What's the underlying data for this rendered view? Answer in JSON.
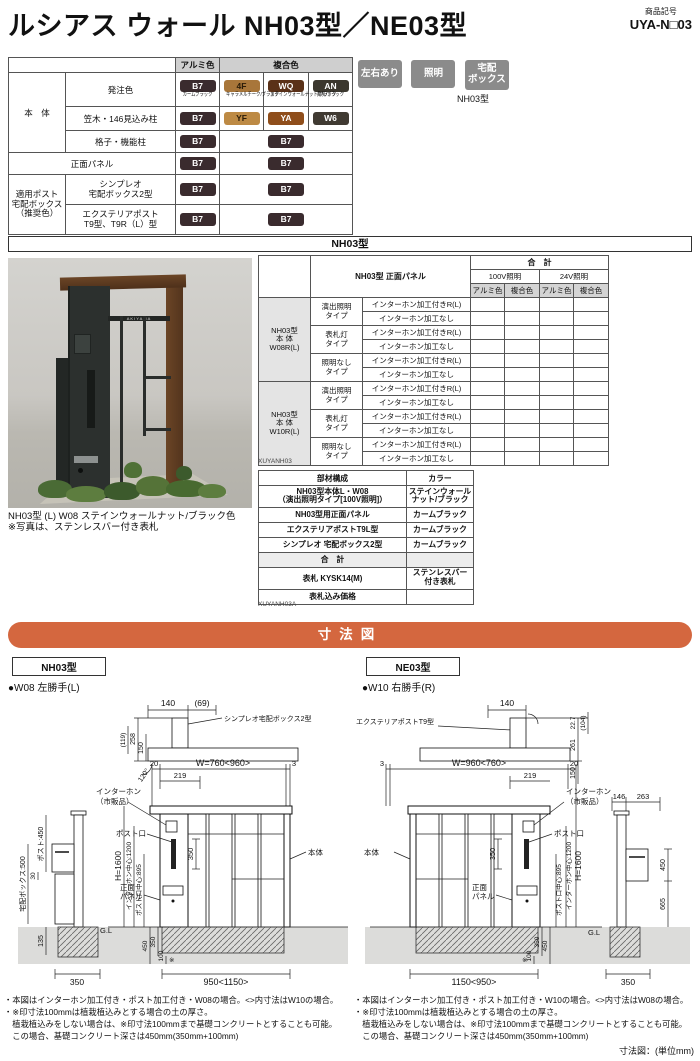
{
  "header": {
    "title": "ルシアス ウォール NH03型／NE03型",
    "code_label": "商品記号",
    "code": "UYA-N□03"
  },
  "feature_badges": {
    "b1": "左右あり",
    "b2": "照明",
    "b3_line1": "宅配",
    "b3_line2": "ボックス",
    "model": "NH03型"
  },
  "colors": {
    "accent_orange": "#d4673f",
    "badge_gray": "#8b8b8b",
    "ground_gray": "#dcdcda",
    "chip_b7": "#3a2b2e",
    "chip_4f": "#a8763a",
    "chip_wq": "#5a3118",
    "chip_an": "#3b372e",
    "chip_yf": "#bd8a44",
    "chip_ya": "#8f4e1b",
    "chip_w6": "#403a32"
  },
  "color_table": {
    "col_alumi": "アルミ色",
    "col_fukugo": "複合色",
    "rows": {
      "hontai": "本　体",
      "hacchusyoku": "発注色",
      "kasagi": "笠木・146見込み柱",
      "koushi": "格子・機能柱",
      "shomen": "正面パネル",
      "tekiyo1": "適用ポスト",
      "tekiyo2": "宅配ボックス",
      "tekiyo3": "（推奨色）",
      "simpleo1": "シンプレオ",
      "simpleo2": "宅配ボックス2型",
      "extpost1": "エクステリアポスト",
      "extpost2": "T9型、T9R（L）型"
    },
    "chips": {
      "b7": {
        "code": "B7",
        "name": "カームブラック"
      },
      "f4": {
        "code": "4F",
        "name": "キャラメルチーク/ブラック"
      },
      "wq": {
        "code": "WQ",
        "name": "ステインウォールナット/ブラック"
      },
      "an": {
        "code": "AN",
        "name": "桑炭/ブラック"
      },
      "yf": {
        "code": "YF"
      },
      "ya": {
        "code": "YA"
      },
      "w6": {
        "code": "W6"
      }
    }
  },
  "model_band": "NH03型",
  "spec_table": {
    "panel_header": "NH03型 正面パネル",
    "total": "合　計",
    "v100": "100V照明",
    "v24": "24V照明",
    "alumi": "アルミ色",
    "fukugo": "複合色",
    "group1": [
      "NH03型",
      "本 体",
      "W08R(L)"
    ],
    "group2": [
      "NH03型",
      "本 体",
      "W10R(L)"
    ],
    "type1": [
      "演出照明",
      "タイプ"
    ],
    "type2": [
      "表札灯",
      "タイプ"
    ],
    "type3": [
      "照明なし",
      "タイプ"
    ],
    "intercom_with": "インターホン加工付きR(L)",
    "intercom_none": "インターホン加工なし",
    "code": "XUYANH03"
  },
  "photo": {
    "nameplate": "AKIYAMA",
    "caption1": "NH03型 (L) W08 ステインウォールナット/ブラック色",
    "caption2": "※写真は、ステンレスバー付き表札"
  },
  "parts_table": {
    "h_part": "部材構成",
    "h_color": "カラー",
    "r1_part1": "NH03型本体L・W08",
    "r1_part2": "（演出照明タイプ[100V照明]）",
    "r1_color1": "ステインウォール",
    "r1_color2": "ナット/ブラック",
    "r2_part": "NH03型用正面パネル",
    "r2_color": "カームブラック",
    "r3_part": "エクステリアポストT9L型",
    "r3_color": "カームブラック",
    "r4_part": "シンプレオ 宅配ボックス2型",
    "r4_color": "カームブラック",
    "total": "合　計",
    "r5_part": "表札 KYSK14(M)",
    "r5_color1": "ステンレスバー",
    "r5_color2": "付き表札",
    "r6_part": "表札込み価格",
    "code": "XUYANH03A"
  },
  "dim_section": {
    "title": "寸法図",
    "unit": "寸法図：(単位mm)",
    "left": {
      "model": "NH03型",
      "variant": "●W08 左勝手(L)",
      "plan": {
        "d140": "140",
        "d69": "(69)",
        "d258": "258",
        "d150": "150",
        "d119": "(119)",
        "angle": "120°",
        "label": "シンプレオ宅配ボックス2型"
      },
      "side": {
        "post": "ポスト:450",
        "d30": "30",
        "takuhai": "宅配ボックス:500",
        "d135": "135",
        "d350": "350"
      },
      "elev": {
        "d20": "20",
        "w": "W=760<960>",
        "d3": "3",
        "d219": "219",
        "intercom1": "インターホン",
        "intercom2": "（市販品）",
        "postguchi": "ポスト口",
        "d350": "350",
        "panel1": "正面",
        "panel2": "パネル",
        "hontai": "本体",
        "h": "H=1600",
        "ic_center": "インターホン中心:1200",
        "post_center": "ポスト口中心:895",
        "gl": "G.L",
        "d450": "450",
        "d350b": "350",
        "d100": "100",
        "kome": "※",
        "w_bottom": "950<1150>"
      },
      "notes": [
        "・本図はインターホン加工付き・ポスト加工付き・W08の場合。<>内寸法はW10の場合。",
        "・※印寸法100mmは植栽植込みとする場合の土の厚さ。",
        "　植栽植込みをしない場合は、※印寸法100mmまで基礎コンクリートとすることも可能。",
        "　この場合、基礎コンクリート深さは450mm(350mm+100mm)"
      ]
    },
    "right": {
      "model": "NE03型",
      "variant": "●W10 右勝手(R)",
      "plan": {
        "d140": "140",
        "d227": "22.7",
        "d104": "(104)",
        "d261": "261",
        "d150": "150",
        "label": "エクステリアポストT9型"
      },
      "side": {
        "d146": "146",
        "d263": "263",
        "d450": "450",
        "d665": "665",
        "d350": "350"
      },
      "elev": {
        "d3": "3",
        "w": "W=960<760>",
        "d20": "20",
        "d219": "219",
        "intercom1": "インターホン",
        "intercom2": "（市販品）",
        "postguchi": "ポスト口",
        "d350": "350",
        "panel1": "正面",
        "panel2": "パネル",
        "hontai": "本体",
        "h": "H=1600",
        "ic_center": "インターホン中心:1200",
        "post_center": "ポスト口中心:895",
        "gl": "G.L",
        "d450": "450",
        "d350b": "350",
        "d100": "100",
        "kome": "※",
        "w_bottom": "1150<950>"
      },
      "notes": [
        "・本図はインターホン加工付き・ポスト加工付き・W10の場合。<>内寸法はW08の場合。",
        "・※印寸法100mmは植栽植込みとする場合の土の厚さ。",
        "　植栽植込みをしない場合は、※印寸法100mmまで基礎コンクリートとすることも可能。",
        "　この場合、基礎コンクリート深さは450mm(350mm+100mm)"
      ]
    }
  }
}
